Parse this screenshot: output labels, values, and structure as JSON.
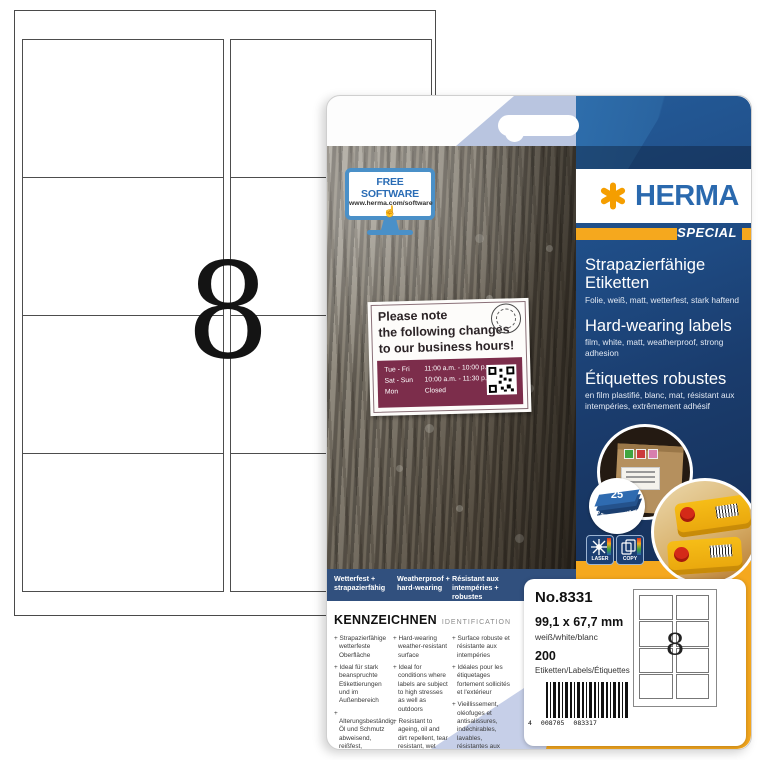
{
  "sheet": {
    "labels_per_sheet": "8"
  },
  "package": {
    "brand": {
      "name": "HERMA",
      "edition": "SPECIAL"
    },
    "free_software": {
      "line1": "FREE SOFTWARE",
      "line2": "www.herma.com/software"
    },
    "sign": {
      "heading1": "Please note",
      "heading2": "the following changes",
      "heading3": "to our business hours!",
      "hours": [
        {
          "days": "Tue - Fri",
          "time": "11:00 a.m. - 10:00 p.m."
        },
        {
          "days": "Sat - Sun",
          "time": "10:00 a.m. - 11:30 p.m."
        },
        {
          "days": "Mon",
          "time": "Closed"
        }
      ]
    },
    "titles": {
      "de": {
        "title": "Strapazierfähige Etiketten",
        "sub": "Folie, weiß, matt, wetterfest, stark haftend"
      },
      "en": {
        "title": "Hard-wearing labels",
        "sub": "film, white, matt, weatherproof, strong adhesion"
      },
      "fr": {
        "title": "Étiquettes robustes",
        "sub": "en film plastifié, blanc, mat, résistant aux intempéries, extrêmement adhésif"
      }
    },
    "sheet_badge": {
      "count": "25",
      "width_mm": "210 mm",
      "height_mm": "297 mm"
    },
    "print_icons": {
      "laser": "LASER",
      "copy": "COPY"
    },
    "feature_band": {
      "de": "Wetterfest + strapazierfähig",
      "en": "Weatherproof + hard-wearing",
      "fr": "Résistant aux intempéries + robustes"
    },
    "identification": {
      "heading": "KENNZEICHNEN",
      "subheading": "IDENTIFICATION",
      "columns": [
        {
          "items": [
            "Strapazierfähige wetterfeste Oberfläche",
            "Ideal für stark beanspruchte Etikettierungen und im Außenbereich",
            "Alterungsbeständig, Öl und Schmutz abweisend, reißfest, abwaschbar, temperaturbeständig von -30 bis +80 °C"
          ]
        },
        {
          "items": [
            "Hard-wearing weather-resistant surface",
            "Ideal for conditions where labels are subject to high stresses as well as outdoors",
            "Resistant to ageing, oil and dirt repellent, tear resistant, wet wipeable, resistant to temperatures between -30 and +80 °C"
          ]
        },
        {
          "items": [
            "Surface robuste et résistante aux intempéries",
            "Idéales pour les étiquetages fortement sollicités et l'extérieur",
            "Vieillissement, oléofuges et antisalissures, indéchirables, lavables, résistantes aux températures de -30 à +80 °C"
          ]
        }
      ]
    },
    "info_card": {
      "number": "No.8331",
      "size": "99,1 x 67,7 mm",
      "color_names": "weiß/white/blanc",
      "count": "200",
      "count_label": "Etiketten/Labels/Étiquettes",
      "barcode_prefix": "4",
      "barcode_group1": "008705",
      "barcode_group2": "083317",
      "labels_per_sheet": "8"
    },
    "made_in": "Made in Germany"
  },
  "colors": {
    "navy": "#1a3c6d",
    "herma_blue": "#2a69ae",
    "orange": "#f5a81e",
    "maroon": "#7c2d4b",
    "light_blue": "#c6cfe8"
  }
}
